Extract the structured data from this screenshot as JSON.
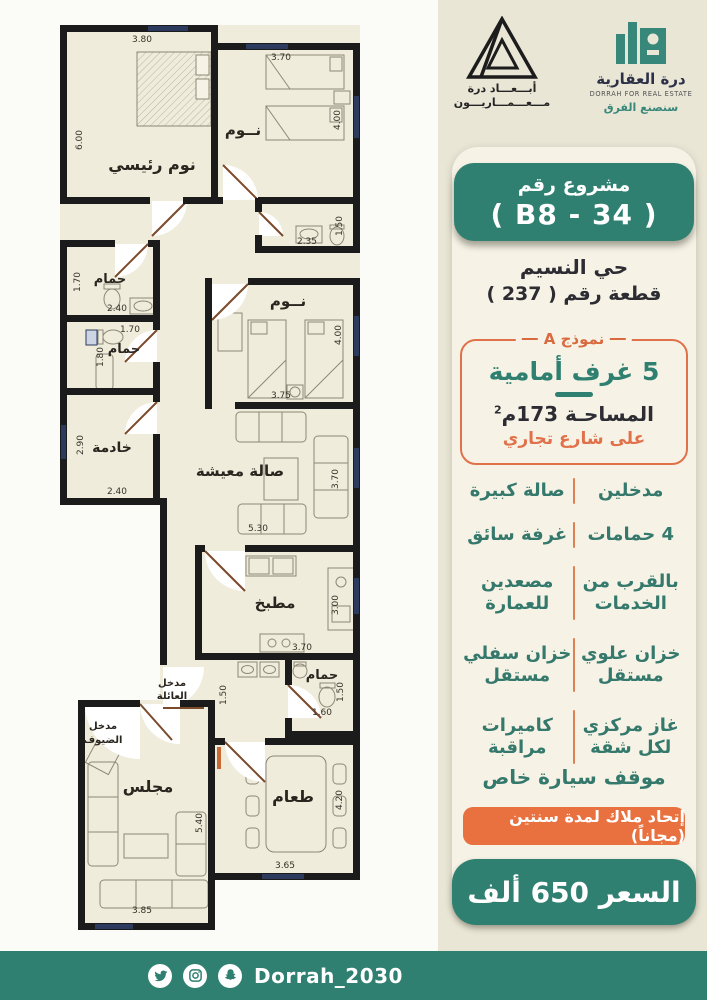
{
  "header": {
    "abaad_logo": {
      "line1": "أبـــعـــاد درة",
      "line2": "مـــعـــمـــاريـــون"
    },
    "dorrah_logo": {
      "name_ar": "درة العقارية",
      "name_en": "DORRAH FOR REAL ESTATE",
      "tagline": "سنصنع الفرق"
    }
  },
  "panel": {
    "project_badge": {
      "line1": "مشروع رقم",
      "line2": "( B8 - 34 )"
    },
    "district": "حي النسيم",
    "plot": "قطعة رقم ( 237 )",
    "model_box": {
      "model_label": "نموذج A",
      "rooms": "5 غرف أمامية",
      "area_prefix": "المساحـة 173م",
      "area_sup": "2",
      "street": "على شارع تجاري"
    },
    "features": [
      [
        "مدخلين",
        "صالة كبيرة"
      ],
      [
        "4 حمامات",
        "غرفة سائق"
      ],
      [
        "بالقرب من الخدمات",
        "مصعدين للعمارة"
      ],
      [
        "خزان علوي مستقل",
        "خزان سفلي مستقل"
      ],
      [
        "غاز مركزي لكل شقة",
        "كاميرات مراقبة"
      ]
    ],
    "parking": "موقف سيارة خاص",
    "hoa_badge": "إتحاد ملاك لمدة سنتين (مجاناً)",
    "price": "السعر 650 ألف"
  },
  "floor_plan": {
    "rooms": {
      "master": "نوم رئيسي",
      "bedroom_top": "نــوم",
      "bedroom_mid": "نــوم",
      "bath1": "حمام",
      "bath2": "حمام",
      "bath3": "حمام",
      "maid": "خادمة",
      "living": "صالة معيشة",
      "kitchen": "مطبخ",
      "majlis": "مجلس",
      "dining": "طعام",
      "family_entry_l1": "مدخل",
      "family_entry_l2": "العائلة",
      "guest_entry_l1": "مدخل",
      "guest_entry_l2": "الضيوف"
    },
    "dims": {
      "master_top": "3.80",
      "master_left": "6.00",
      "bed2_top": "3.70",
      "bed2_right": "4.00",
      "sbath_right": "1.50",
      "sbath_bottom": "2.35",
      "bath1_left": "1.70",
      "bath1_bottom": "2.40",
      "bath2_top": "1.70",
      "bath2_left": "1.80",
      "maid_left": "2.90",
      "maid_bottom": "2.40",
      "bed3_bottom": "3.75",
      "bed3_right": "4.00",
      "living_bottom": "5.30",
      "living_right": "3.70",
      "kitchen_right": "3.00",
      "kitchen_bottom": "3.70",
      "hall": "1.50",
      "bath3_right": "1.50",
      "bath3_bottom": "1.60",
      "majlis_right": "5.40",
      "majlis_bottom": "3.85",
      "dining_right": "4.20",
      "dining_bottom": "3.65"
    }
  },
  "footer": {
    "handle": "Dorrah_2030",
    "icons": [
      "twitter-icon",
      "instagram-icon",
      "snapchat-icon"
    ]
  },
  "colors": {
    "teal": "#2f8071",
    "orange": "#e8713f",
    "cream": "#efecdb",
    "navy": "#2c3a5e",
    "beige": "#e9e6d6"
  }
}
